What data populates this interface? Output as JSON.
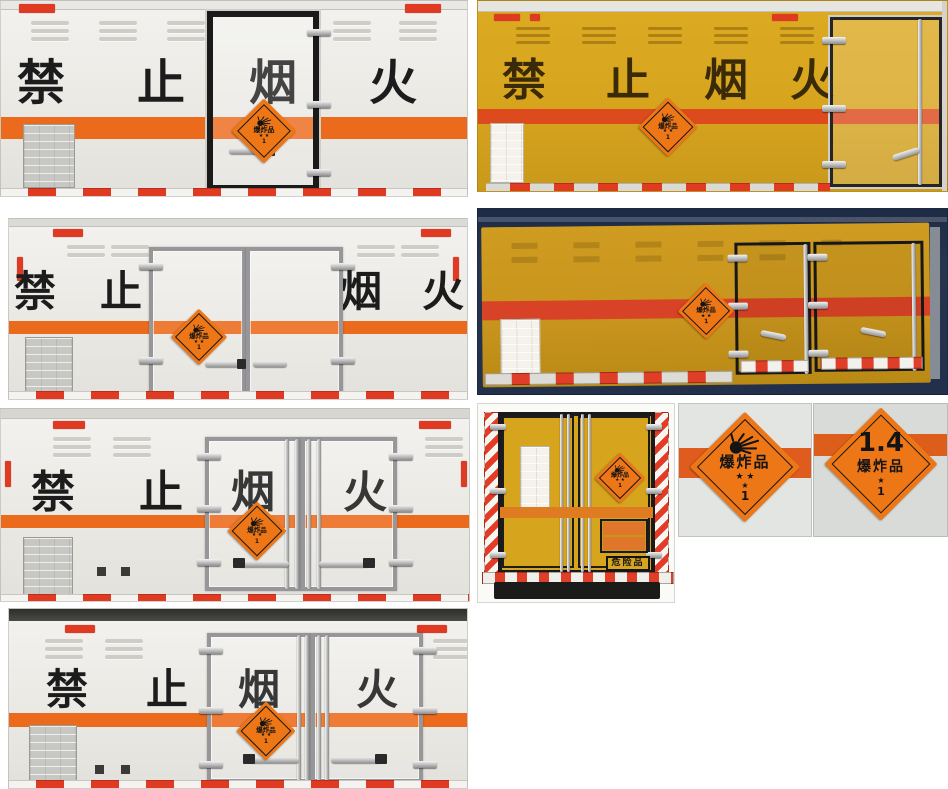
{
  "page": {
    "width": 948,
    "height": 789,
    "description": "photo collage of explosive-goods transport box trucks"
  },
  "colors": {
    "truck_white": "#EDEBE7",
    "truck_yellow": "#D7A41E",
    "truck_amber": "#C8941D",
    "stripe_orange": "#EC6A1C",
    "stripe_red": "#DC4A1E",
    "placard_orange": "#ED7717",
    "reflector_red": "#E03A22",
    "navy_background": "#26344F",
    "frame_black": "#1A1A1A",
    "frame_silver": "#97979A"
  },
  "slogan": {
    "text": "禁止烟火",
    "chars": [
      "禁",
      "止",
      "烟",
      "火"
    ]
  },
  "placard": {
    "label": "爆炸品",
    "stars_top": "★ ★",
    "star": "★",
    "class_number": "1"
  },
  "placard_14": {
    "code": "1.4",
    "label": "爆炸品",
    "star": "★",
    "class_number": "1"
  },
  "danger_plate": {
    "label": "危险品"
  }
}
